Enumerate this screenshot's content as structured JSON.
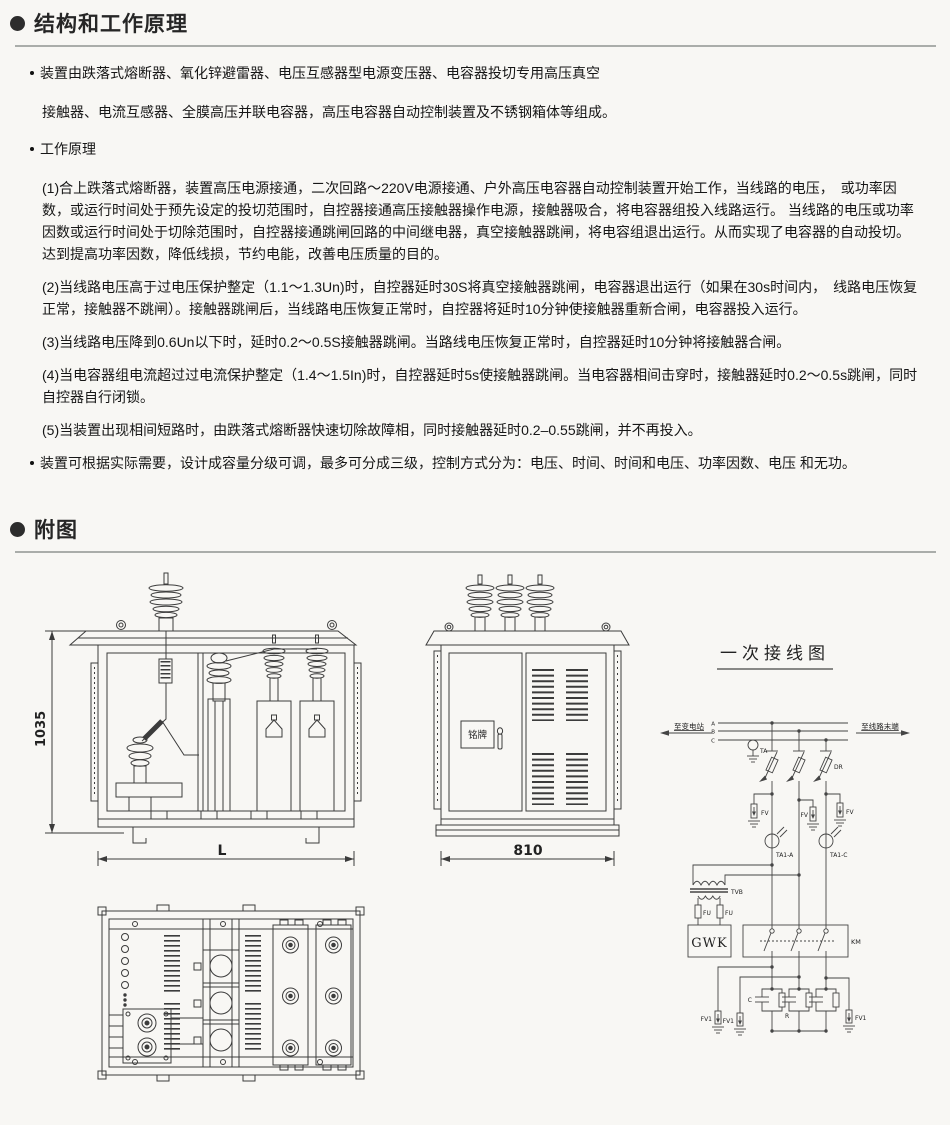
{
  "header1": {
    "title": "结构和工作原理"
  },
  "intro": {
    "line1": "装置由跌落式熔断器、氧化锌避雷器、电压互感器型电源变压器、电容器投切专用高压真空",
    "line2": "接触器、电流互感器、全膜高压并联电容器，高压电容器自动控制装置及不锈钢箱体等组成。"
  },
  "principle": {
    "label": "工作原理",
    "items": [
      {
        "text": "(1)合上跌落式熔断器，装置高压电源接通，二次回路～220V电源接通、户外高压电容器自动控制装置开始工作，当线路的电压，　或功率因数，或运行时间处于预先设定的投切范围时，自控器接通高压接触器操作电源，接触器吸合，将电容器组投入线路运行。 当线路的电压或功率因数或运行时间处于切除范围时，自控器接通跳闸回路的中间继电器，真空接触器跳闸，将电容组退出运行。从而实现了电容器的自动投切。达到提高功率因数，降低线损，节约电能，改善电压质量的目的。"
      },
      {
        "text": "(2)当线路电压高于过电压保护整定（1.1～1.3Un)时，自控器延时30S将真空接触器跳闸，电容器退出运行（如果在30s时间内，　线路电压恢复正常，接触器不跳闸）。接触器跳闸后，当线路电压恢复正常时，自控器将延时10分钟使接触器重新合闸，电容器投入运行。"
      },
      {
        "text": "(3)当线路电压降到0.6Un以下时，延时0.2～0.5S接触器跳闸。当路线电压恢复正常时，自控器延时10分钟将接触器合闸。"
      },
      {
        "text": "(4)当电容器组电流超过过电流保护整定（1.4～1.5In)时，自控器延时5s使接触器跳闸。当电容器相间击穿时，接触器延时0.2～0.5s跳闸，同时自控器自行闭锁。"
      },
      {
        "text": "(5)当装置出现相间短路时，由跌落式熔断器快速切除故障相，同时接触器延时0.2–0.55跳闸，并不再投入。"
      }
    ]
  },
  "closing": "装置可根据实际需要，设计成容量分级可调，最多可分成三级，控制方式分为：电压、时间、时间和电压、功率因数、电压 和无功。",
  "header2": {
    "title": "附图"
  },
  "figure": {
    "front_view": {
      "height_dim": "1035",
      "width_dim": "L"
    },
    "side_view": {
      "width_dim": "810",
      "nameplate": "铭牌"
    },
    "schematic": {
      "title": "一次接线图",
      "left_label": "至变电站",
      "right_label": "至线路末端",
      "bus_a": "A",
      "bus_b": "B",
      "bus_c": "C",
      "ta": "TA",
      "dr": "DR",
      "fv": "FV",
      "fv1": "FV1",
      "ct_a": "TA1-A",
      "ct_c": "TA1-C",
      "tvb": "TVB",
      "fu": "FU",
      "gwk": "GWK",
      "km": "KM",
      "cap": "C",
      "res": "R"
    },
    "caption": "图1. 柱上式高压无动自动补偿装置示意图(容量固定)"
  }
}
